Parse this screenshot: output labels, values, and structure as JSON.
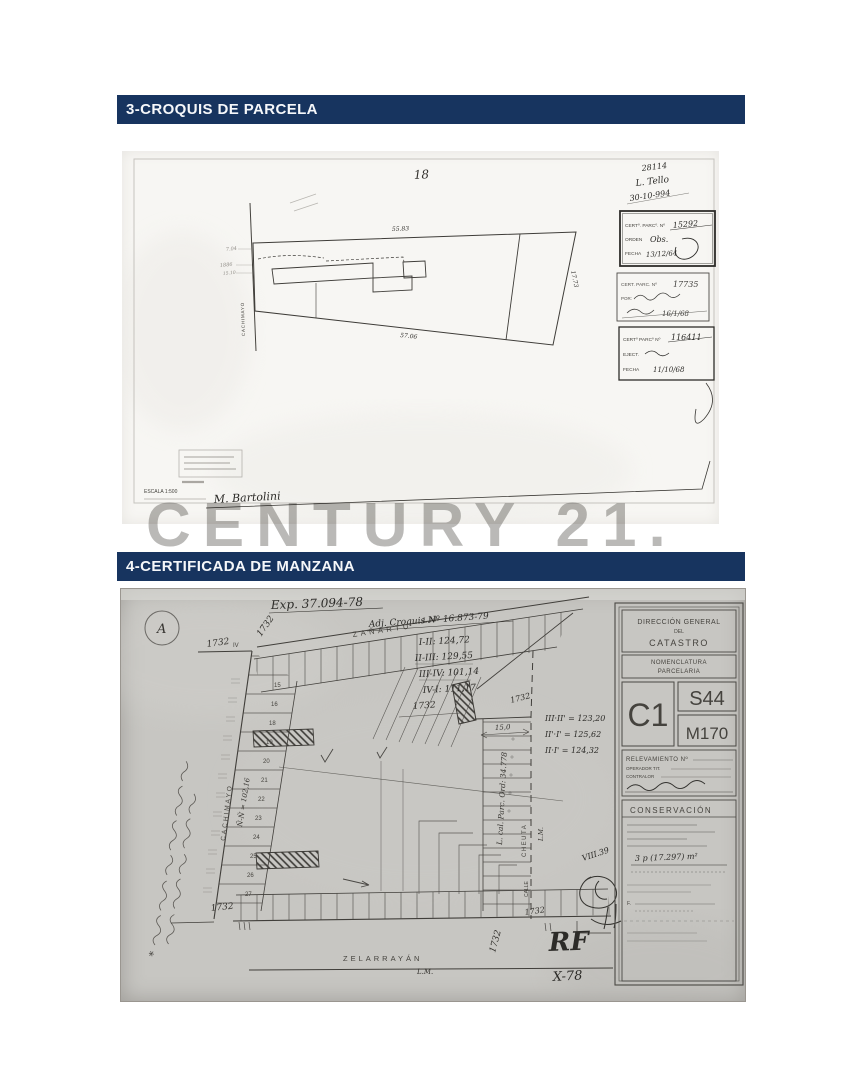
{
  "window": {
    "width": 864,
    "height": 1080,
    "background": "#ffffff"
  },
  "colors": {
    "header_bg": "#17345f",
    "header_text": "#f5f7fa",
    "pencil": "#45433e",
    "watermark": "#aeadab",
    "scan1_bg": "#f7f6f3",
    "scan2_bg": "#c7c6c2"
  },
  "headers": {
    "croquis": "3-CROQUIS DE PARCELA",
    "manzana": "4-CERTIFICADA DE MANZANA"
  },
  "watermark": {
    "text": "CENTURY 21."
  },
  "croquis": {
    "plot_number": "18",
    "street": "CACHIMAYO",
    "dim_top": "55.83",
    "dim_bottom": "57.06",
    "dim_right": "17.73",
    "small_dims": [
      "7.04",
      "1886",
      "15.10"
    ],
    "hand_top": [
      "28114",
      "L. Tello",
      "30-10-994"
    ],
    "stamp1": {
      "l1": "CERTº. PARCº. Nº",
      "v1": "15292",
      "l2": "ORDEN",
      "v2": "Obs.",
      "l3": "FECHA",
      "v3": "13/12/64"
    },
    "stamp2": {
      "l1": "CERT. PARC. Nº",
      "v1": "17735",
      "l2": "POR:",
      "v3": "16/1/68"
    },
    "stamp3": {
      "l1": "CERTº PARCº Nº",
      "v1": "116411",
      "l2": "EJECT.",
      "l3": "FECHA",
      "v3": "11/10/68"
    },
    "scale": "ESCALA 1:500",
    "signature": "M. Bartolini"
  },
  "manzana": {
    "corner_mark": "A",
    "exp": "Exp. 37.094-78",
    "adj": "Adj. Croquis Nº 16.873-79",
    "meas": [
      "I-II: 124,72",
      "II-III: 129,55",
      "III-IV: 101,14",
      "IV-I: 111,17"
    ],
    "meas2": [
      "III·II' = 123,20",
      "II'·I' = 125,62",
      "II·I' = 124,32"
    ],
    "street_top": "ZAÑARTÚ",
    "street_left": "CACHIMAYO",
    "street_bottom": "ZELARRAYÁN",
    "street_right_1": "CALLE",
    "street_right_2": "CHEUTA",
    "lm": "L.M.",
    "c1732": "1732",
    "iv": "IV",
    "asterisk": "*",
    "left_lots": [
      "15",
      "16",
      "18",
      "19",
      "20",
      "21",
      "22",
      "23",
      "24",
      "25",
      "26",
      "27"
    ],
    "cach_meas": "Ñ-Ñ = 102,16",
    "ord_note": "L. cal. Parc. Ord: 34.778",
    "dim15": "15,0",
    "rf": "RF",
    "x78": "X-78",
    "scribble_note": "VIII.39",
    "tb": {
      "t1": "DIRECCIÓN GENERAL",
      "t2": "DEL",
      "t3": "CATASTRO",
      "t4": "NOMENCLATURA",
      "t5": "PARCELARIA",
      "c1": "C1",
      "s44": "S44",
      "m170": "M170",
      "relev": "RELEVAMIENTO Nº",
      "op": "OPERADOR TIT.",
      "contralor": "CONTRALOR",
      "conserv": "CONSERVACIÓN",
      "hand_area": "3 p (17.297) m²",
      "f_line": "F."
    }
  }
}
